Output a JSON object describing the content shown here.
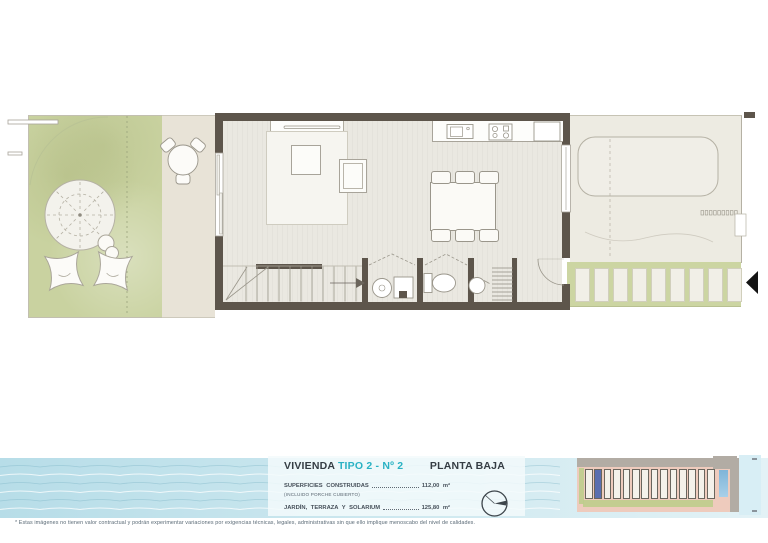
{
  "title_block": {
    "title": "VIVIENDA",
    "title_accent": "TIPO 2 - Nº 2",
    "plan_name": "PLANTA BAJA",
    "rows": [
      {
        "label": "SUPERFICIES CONSTRUIDAS",
        "sublabel": "(INCLUIDO PORCHE CUBIERTO)",
        "value": "112,00 m²"
      },
      {
        "label": "JARDÍN, TERRAZA Y SOLARIUM",
        "sublabel": "",
        "value": "125,80 m²"
      }
    ]
  },
  "footer": {
    "disclaimer": "* Estas imágenes no tienen valor contractual y podrán experimentar variaciones por exigencias técnicas, legales, administrativas sin que ello implique menoscabo del nivel de calidades."
  },
  "colors": {
    "accent": "#2ab2c4",
    "wall": "#5d554b",
    "garden": "#c9d2a0",
    "terrace": "#edebe2",
    "walkway": "#ccd5a2",
    "highlight_unit": "#5a6fb0",
    "water": "#bfe2ea"
  },
  "plan": {
    "walkway_pads": 9,
    "stair_treads": 11,
    "dining_chairs": 6,
    "parasol_spokes": 8,
    "shelf_lines": 9,
    "terrace_dots": 9,
    "siteplan_units": 14,
    "siteplan_highlight_index": 1,
    "wave_lines": 6
  }
}
